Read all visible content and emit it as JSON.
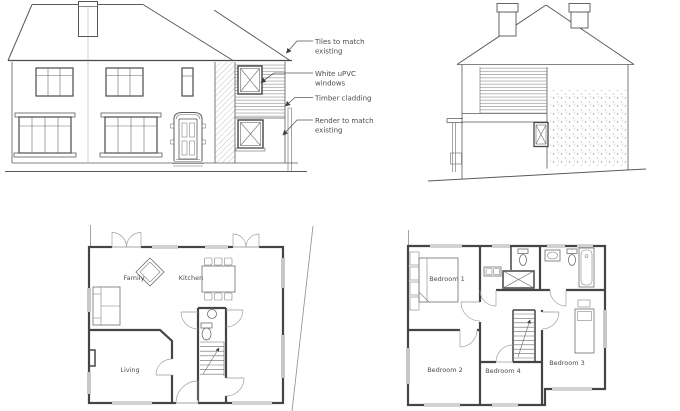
{
  "front_elevation": {
    "annotations": {
      "tiles_line1": "Tiles to match",
      "tiles_line2": "existing",
      "windows_line1": "White uPVC",
      "windows_line2": "windows",
      "cladding": "Timber cladding",
      "render_line1": "Render to match",
      "render_line2": "existing"
    }
  },
  "ground_floor_plan": {
    "rooms": {
      "family": "Family",
      "kitchen": "Kitchen",
      "living": "Living"
    }
  },
  "first_floor_plan": {
    "rooms": {
      "bedroom1": "Bedroom 1",
      "bedroom2": "Bedroom 2",
      "bedroom3": "Bedroom 3",
      "bedroom4": "Bedroom 4"
    }
  },
  "colors": {
    "line": "#5a5a5a",
    "wall": "#454545",
    "text": "#4d4d4d",
    "paper": "#ffffff"
  }
}
